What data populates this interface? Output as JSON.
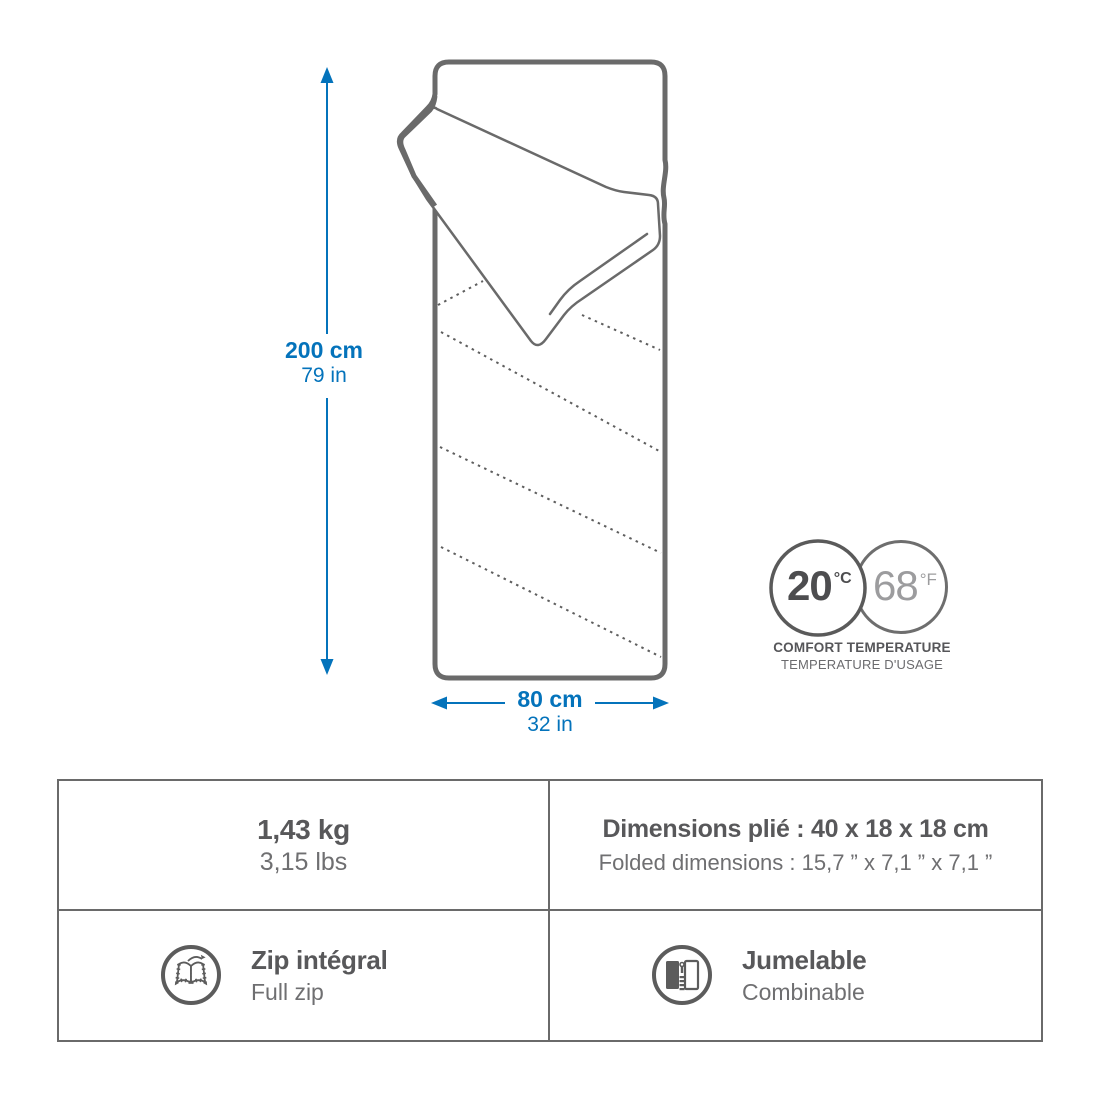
{
  "diagram": {
    "height": {
      "metric": "200 cm",
      "imperial": "79 in"
    },
    "width": {
      "metric": "80 cm",
      "imperial": "32 in"
    },
    "comfort": {
      "celsius_value": "20",
      "celsius_unit": "°C",
      "fahrenheit_value": "68",
      "fahrenheit_unit": "°F",
      "label_line1": "COMFORT TEMPERATURE",
      "label_line2": "TEMPERATURE D'USAGE"
    }
  },
  "specs": {
    "weight": {
      "metric": "1,43 kg",
      "imperial": "3,15 lbs"
    },
    "folded": {
      "fr": "Dimensions plié : 40 x 18 x 18 cm",
      "en": "Folded dimensions : 15,7 ” x 7,1 ” x 7,1 ”"
    },
    "zip": {
      "fr": "Zip intégral",
      "en": "Full zip",
      "icon": "open-sleeping-bag-icon"
    },
    "combine": {
      "fr": "Jumelable",
      "en": "Combinable",
      "icon": "zipper-join-icon"
    }
  },
  "colors": {
    "accent_blue": "#0473bb",
    "line_gray": "#6a6a6a",
    "text_dark": "#58585a",
    "text_mid": "#6f6f71",
    "text_light": "#9c9c9e"
  }
}
